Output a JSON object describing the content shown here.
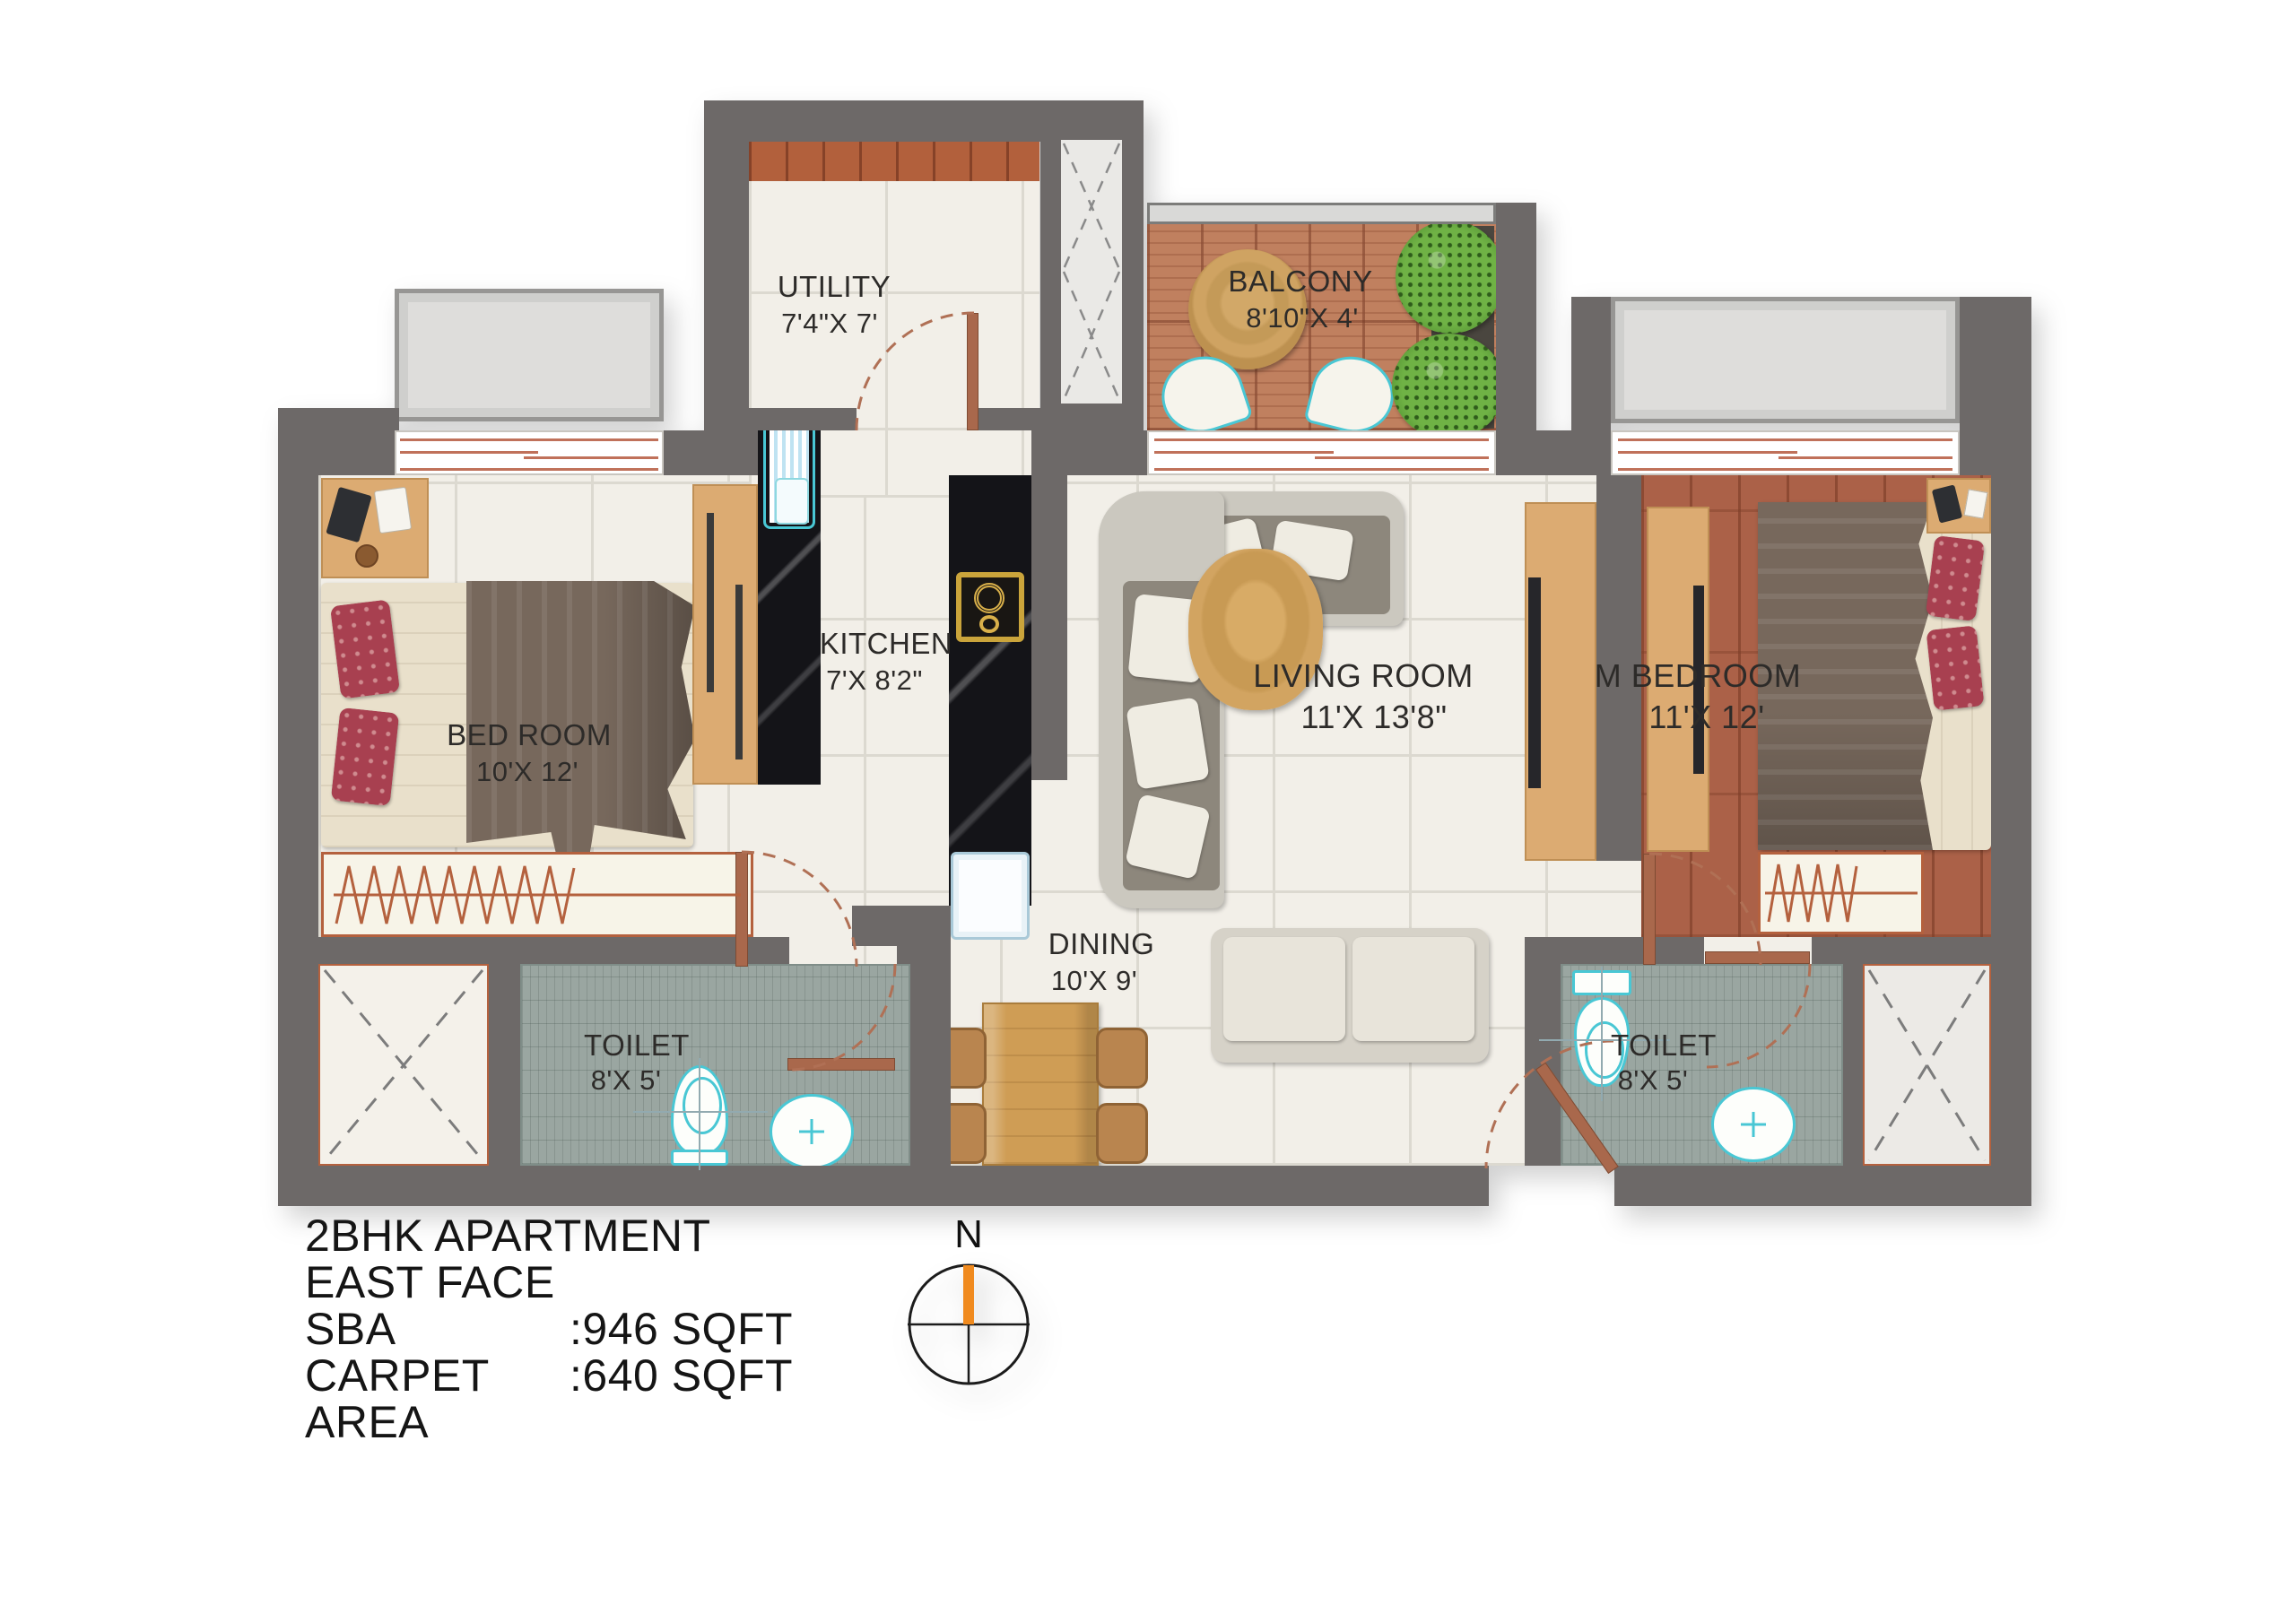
{
  "rooms": {
    "utility": {
      "name": "UTILITY",
      "dims": "7'4\"X 7'"
    },
    "balcony": {
      "name": "BALCONY",
      "dims": "8'10\"X 4'"
    },
    "kitchen": {
      "name": "KITCHEN",
      "dims": "7'X 8'2\""
    },
    "living_room": {
      "name": "LIVING ROOM",
      "dims": "11'X 13'8\""
    },
    "master_bedroom": {
      "name": "M BEDROOM",
      "dims": "11'X 12'"
    },
    "bedroom": {
      "name": "BED ROOM",
      "dims": "10'X 12'"
    },
    "dining": {
      "name": "DINING",
      "dims": "10'X 9'"
    },
    "toilet_left": {
      "name": "TOILET",
      "dims": "8'X 5'"
    },
    "toilet_right": {
      "name": "TOILET",
      "dims": "8'X 5'"
    }
  },
  "compass": {
    "north": "N"
  },
  "title_block": {
    "title": "2BHK APARTMENT",
    "facing": "EAST FACE",
    "sba_label": "SBA",
    "sba_value": ":946 SQFT",
    "carpet_label": "CARPET AREA",
    "carpet_value": ":640 SQFT"
  },
  "colors": {
    "wall": "#6d6968",
    "terracotta_accent": "#b2603c",
    "fixture_teal": "#49c7d4",
    "compass_north_bar": "#f08a1e",
    "wood_furniture": "#dcab72",
    "balcony_deck": "#c0805f",
    "master_floor": "#ab6148",
    "toilet_floor": "#9aa6a1"
  }
}
